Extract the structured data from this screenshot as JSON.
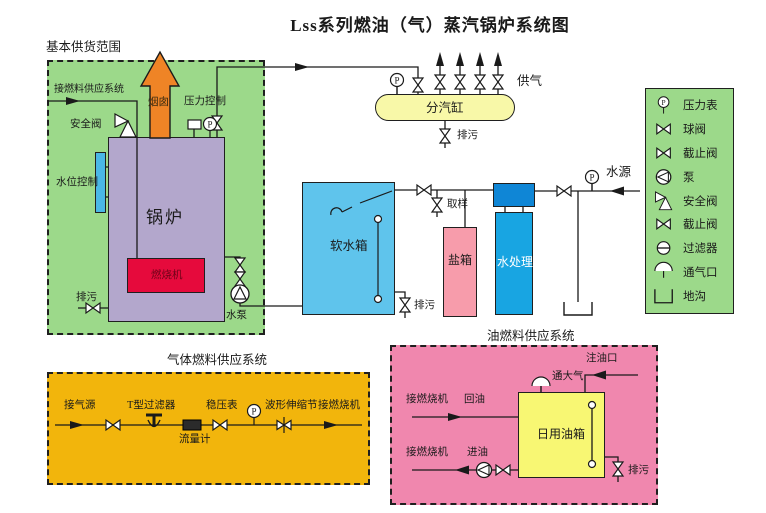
{
  "title": "Lss系列燃油（气）蒸汽锅炉系统图",
  "symbols": {
    "gauge_letter": "P"
  },
  "supply_scope": {
    "label": "基本供货范围",
    "fuel_inlet": "接燃料供应系统",
    "safety_valve": "安全阀",
    "chimney": "烟囱",
    "pressure_control": "压力控制",
    "water_level_control": "水位控制",
    "boiler": "锅炉",
    "burner": "燃烧机",
    "blowdown": "排污",
    "feed_pump": "水泵"
  },
  "steam_header": {
    "name": "分汽缸",
    "steam_out": "供气",
    "blowdown": "排污"
  },
  "water_system": {
    "soft_tank": "软水箱",
    "blowdown": "排污",
    "sampling": "取样",
    "salt_tank": "盐箱",
    "treatment": "水处理",
    "source": "水源"
  },
  "legend": {
    "items": [
      {
        "icon": "pressure-gauge",
        "label": "压力表"
      },
      {
        "icon": "ball-valve",
        "label": "球阀"
      },
      {
        "icon": "stop-valve",
        "label": "截止阀"
      },
      {
        "icon": "pump",
        "label": "泵"
      },
      {
        "icon": "safety-valve",
        "label": "安全阀"
      },
      {
        "icon": "stop-valve",
        "label": "截止阀"
      },
      {
        "icon": "filter",
        "label": "过滤器"
      },
      {
        "icon": "vent",
        "label": "通气口"
      },
      {
        "icon": "trench",
        "label": "地沟"
      }
    ]
  },
  "gas_fuel_system": {
    "title": "气体燃料供应系统",
    "gas_source": "接气源",
    "t_filter": "T型过滤器",
    "flow_meter": "流量计",
    "regulator_gauge": "稳压表",
    "expansion_joint": "波形伸缩节",
    "to_burner": "接燃烧机"
  },
  "oil_fuel_system": {
    "title": "油燃料供应系统",
    "fill_port": "注油口",
    "atmosphere_vent": "通大气",
    "to_burner_return": "接燃烧机",
    "return_oil": "回油",
    "to_burner_inlet": "接燃烧机",
    "inlet_oil": "进油",
    "day_tank": "日用油箱",
    "blowdown": "排污"
  },
  "colors": {
    "scope_green": "#9cd98a",
    "gas_box_gold": "#f2b50c",
    "oil_box_pink": "#f087ae",
    "boiler_purple": "#b3a7cc",
    "burner_red": "#e60a3c",
    "chimney_orange": "#ef8426",
    "soft_tank_blue": "#5fc4ec",
    "salt_tank_pink": "#f79cab",
    "treatment_blue": "#18a5e2",
    "treatment_head_blue": "#0f86d6",
    "steam_header_yellow": "#f8f8a8",
    "oil_tank_yellow": "#f8f773",
    "level_bar_blue": "#4ab7e6"
  }
}
